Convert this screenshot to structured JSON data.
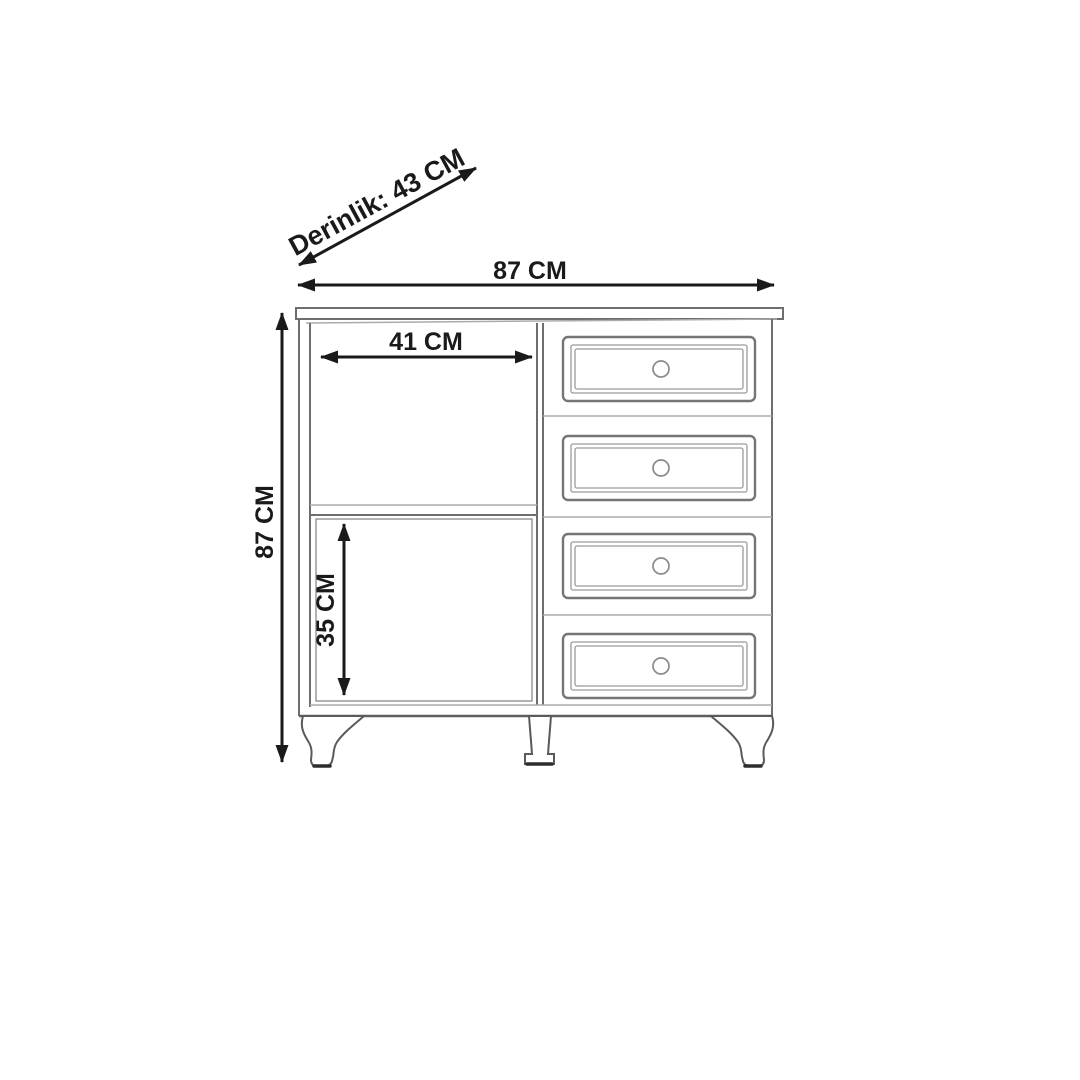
{
  "colors": {
    "background": "#ffffff",
    "dimension_ink": "#1a1a1a",
    "cabinet_line": "#6e6e6e",
    "light_line": "#ababab"
  },
  "dimensions": {
    "depth": {
      "label": "Derinlik: 43 CM",
      "value": 43,
      "unit": "CM"
    },
    "overall_width": {
      "label": "87 CM",
      "value": 87,
      "unit": "CM"
    },
    "overall_height": {
      "label": "87 CM",
      "value": 87,
      "unit": "CM"
    },
    "left_compartment_width": {
      "label": "41 CM",
      "value": 41,
      "unit": "CM"
    },
    "lower_compartment_height": {
      "label": "35 CM",
      "value": 35,
      "unit": "CM"
    }
  },
  "furniture": {
    "drawer_count": 4,
    "knob_count": 4,
    "leg_count": 3
  }
}
